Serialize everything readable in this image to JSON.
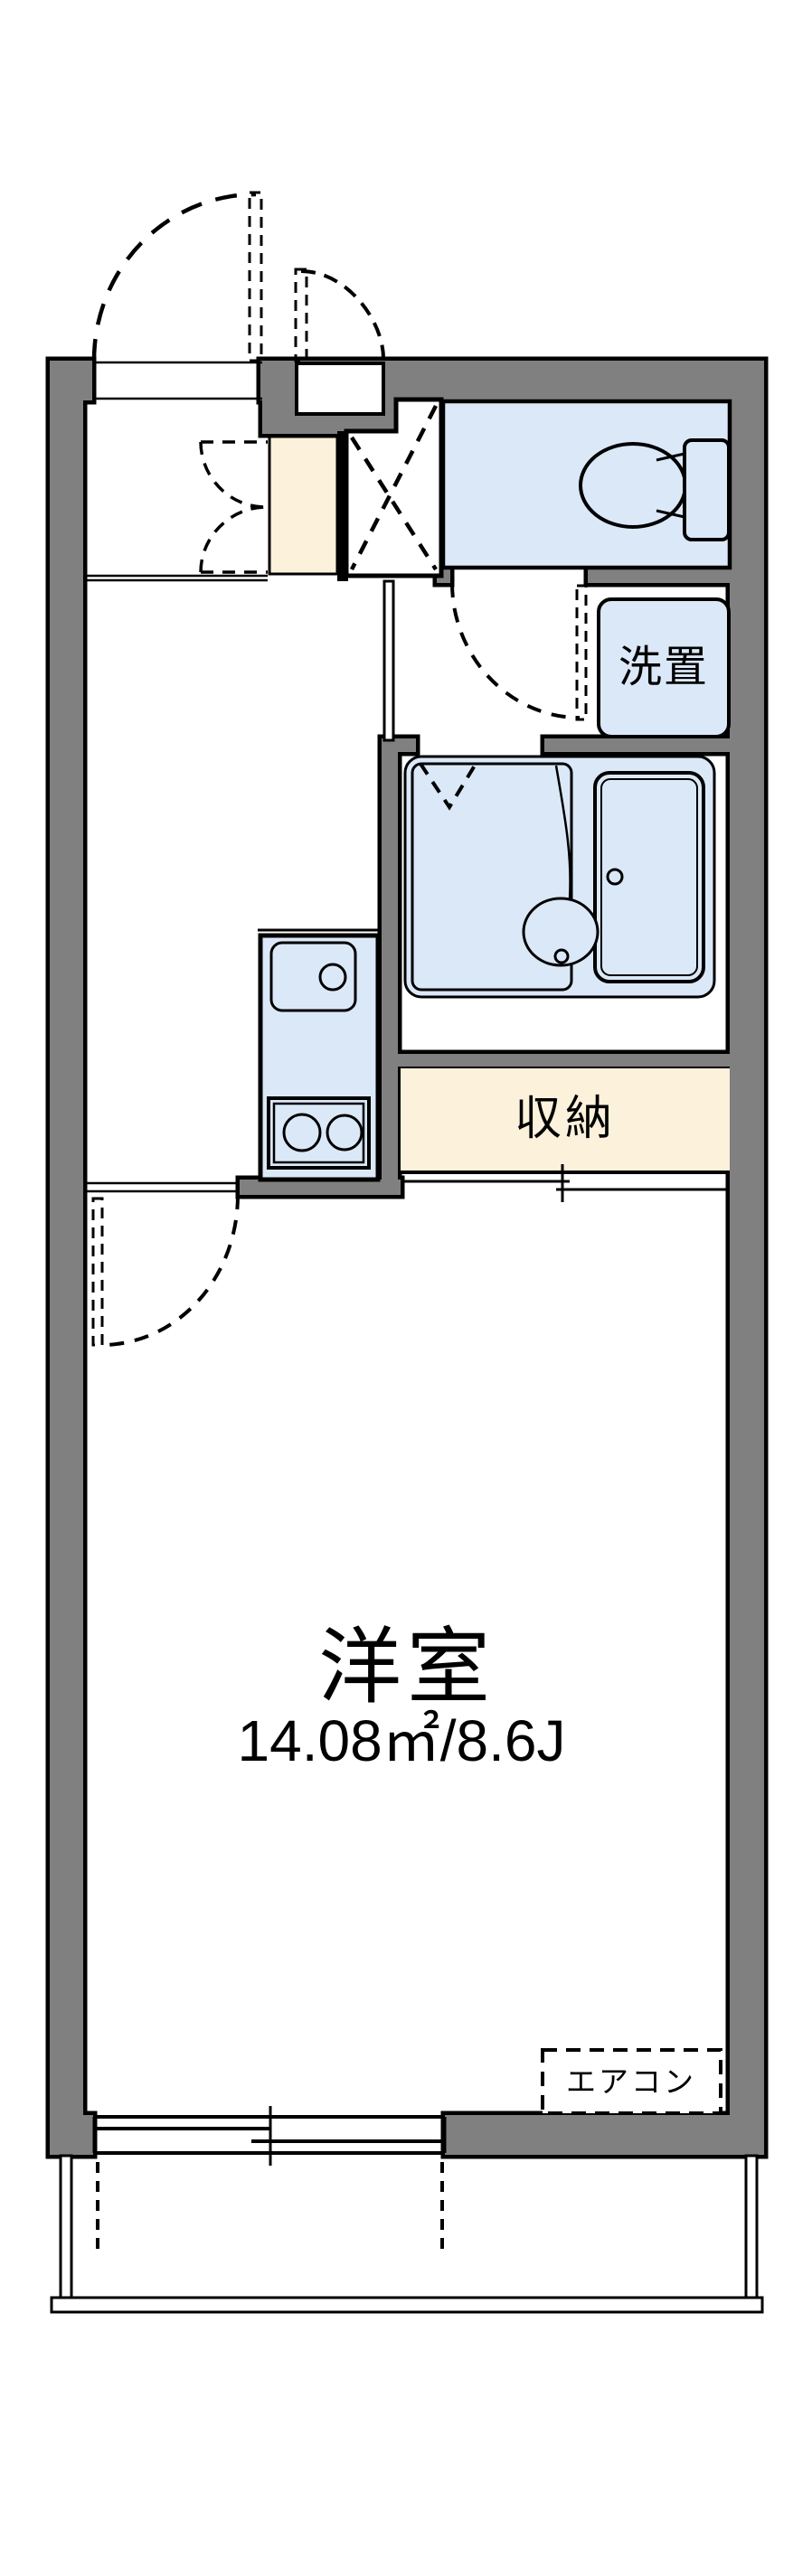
{
  "colors": {
    "wall_gray": "#808080",
    "unit_blue": "#dbe8f8",
    "storage_cream": "#fcf1da",
    "line_black": "#000000",
    "background": "#ffffff"
  },
  "labels": {
    "main_room": "洋室",
    "main_room_area": "14.08㎡/8.6J",
    "storage": "収納",
    "washer_place": "洗置",
    "air_conditioner": "エアコン"
  }
}
